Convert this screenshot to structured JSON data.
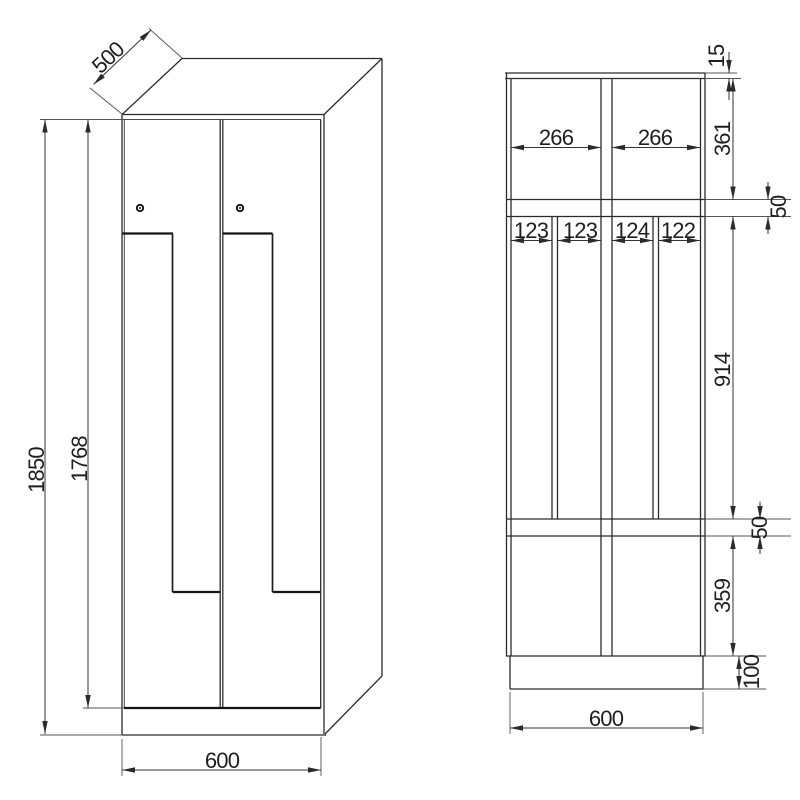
{
  "front_view": {
    "depth": "500",
    "total_height": "1850",
    "door_height": "1768",
    "width": "600"
  },
  "section_view": {
    "top_panel": "15",
    "upper_compartment": "361",
    "upper_shelf": "50",
    "middle_compartment": "914",
    "lower_shelf": "50",
    "lower_compartment": "359",
    "plinth": "100",
    "bay_left": "266",
    "bay_right": "266",
    "slots": [
      "123",
      "123",
      "124",
      "122"
    ],
    "width": "600"
  }
}
